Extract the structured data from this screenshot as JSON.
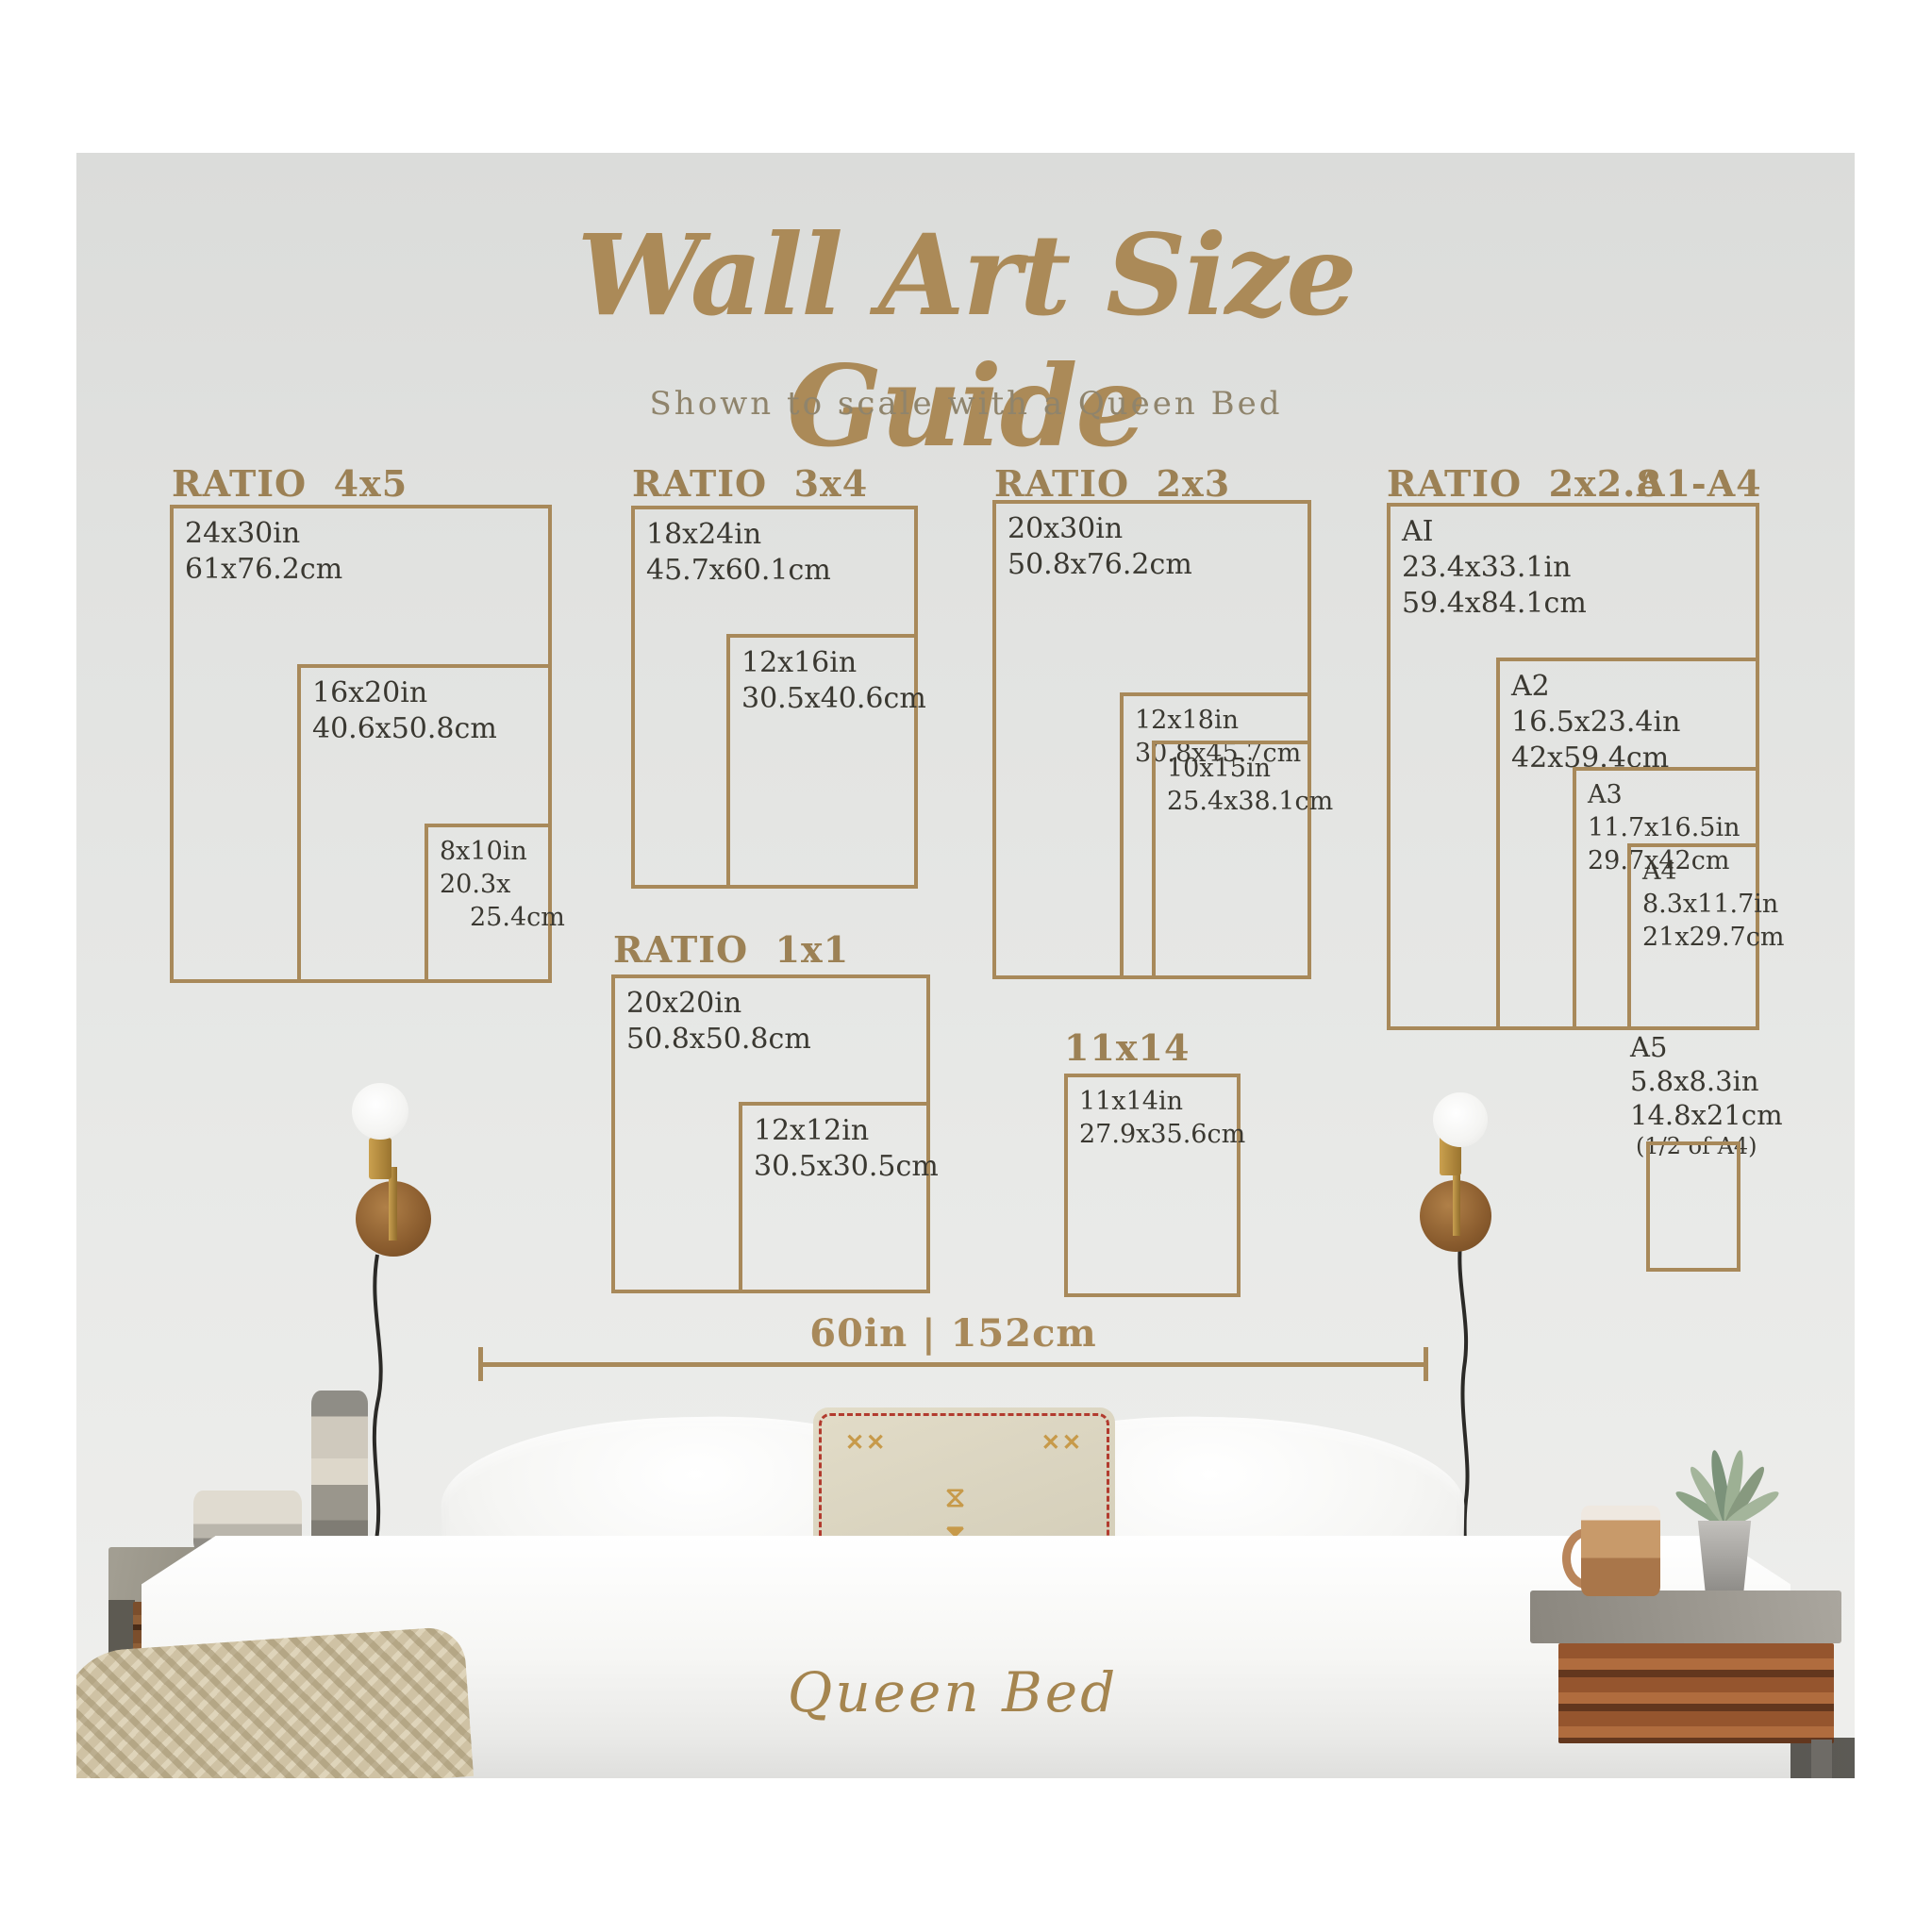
{
  "header": {
    "title": "Wall Art Size Guide",
    "subtitle": "Shown to scale with a Queen Bed"
  },
  "groups": {
    "g4x5": "RATIO  4x5",
    "g3x4": "RATIO  3x4",
    "g2x3": "RATIO  2x3",
    "g2x28": "RATIO  2x2.8",
    "gA1A4": "A1-A4",
    "g1x1": "RATIO  1x1",
    "g11x14": "11x14"
  },
  "frames": {
    "f24x30": {
      "l1": "24x30in",
      "l2": "61x76.2cm"
    },
    "f16x20": {
      "l1": "16x20in",
      "l2": "40.6x50.8cm"
    },
    "f8x10": {
      "l1": "8x10in",
      "l2": "20.3x",
      "l3": "25.4cm"
    },
    "f18x24": {
      "l1": "18x24in",
      "l2": "45.7x60.1cm"
    },
    "f12x16": {
      "l1": "12x16in",
      "l2": "30.5x40.6cm"
    },
    "f20x30": {
      "l1": "20x30in",
      "l2": "50.8x76.2cm"
    },
    "f12x18": {
      "l1": "12x18in",
      "l2": "30.8x45.7cm"
    },
    "f10x15": {
      "l1": "10x15in",
      "l2": "25.4x38.1cm"
    },
    "fA1": {
      "l1": "AI",
      "l2": "23.4x33.1in",
      "l3": "59.4x84.1cm"
    },
    "fA2": {
      "l1": "A2",
      "l2": "16.5x23.4in",
      "l3": "42x59.4cm"
    },
    "fA3": {
      "l1": "A3",
      "l2": "11.7x16.5in",
      "l3": "29.7x42cm"
    },
    "fA4": {
      "l1": "A4",
      "l2": "8.3x11.7in",
      "l3": "21x29.7cm"
    },
    "fA5": {
      "l1": "A5",
      "l2": "5.8x8.3in",
      "l3": "14.8x21cm",
      "l4": "(1/2 of A4)"
    },
    "f20x20": {
      "l1": "20x20in",
      "l2": "50.8x50.8cm"
    },
    "f12x12": {
      "l1": "12x12in",
      "l2": "30.5x30.5cm"
    },
    "f11x14": {
      "l1": "11x14in",
      "l2": "27.9x35.6cm"
    }
  },
  "measure": {
    "label": "60in | 152cm"
  },
  "footer": {
    "bed_label": "Queen Bed"
  },
  "colors": {
    "gold_lines": "#a8895a",
    "gold_titles": "#9c8155",
    "label_text": "#3a3831",
    "wall": "#e3e4e2"
  }
}
